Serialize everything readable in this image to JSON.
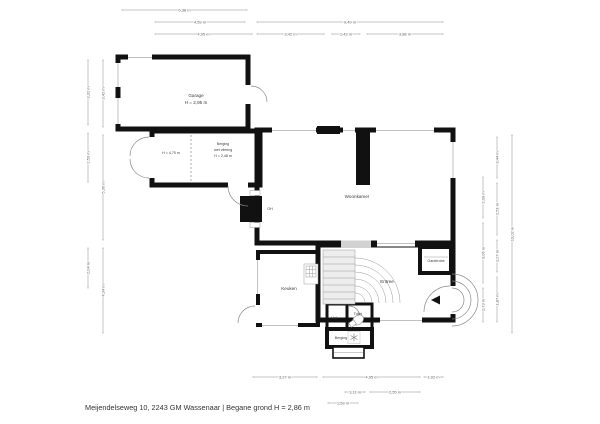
{
  "footer": {
    "text": "Meijendelseweg 10, 2243 GM Wassenaar | Begane grond H = 2,86 m"
  },
  "colors": {
    "wall": "#111111",
    "room_gray": "#d2d2d2",
    "room_pink": "#e8d0cb",
    "room_blue": "#aecbdf",
    "stair_fill": "#ededed"
  },
  "rooms": {
    "garage": {
      "label": "Garage",
      "height": "H = 2,95 m"
    },
    "berging": {
      "label": "Berging",
      "label2": "met vliering",
      "height": "H = 2,48 m"
    },
    "berging_links": {
      "height": "H = 4,70 m"
    },
    "woonkamer": {
      "label": "Woonkamer"
    },
    "open_haard": {
      "label": "OH"
    },
    "keuken": {
      "label": "Keuken"
    },
    "entree": {
      "label": "Entree"
    },
    "garderobe": {
      "label": "Garderobe"
    },
    "hal": {
      "label": "Hal"
    },
    "toilet": {
      "label": "Toilet"
    },
    "berging_klein": {
      "label": "Berging"
    }
  },
  "dims": {
    "top": [
      {
        "label": "6,38 m"
      },
      {
        "label": "4,59 m"
      },
      {
        "label": "9,49 m"
      },
      {
        "label": "4,95 m"
      },
      {
        "label": "3,42 m"
      },
      {
        "label": "1,43 m"
      },
      {
        "label": "3,88 m"
      }
    ],
    "left": [
      {
        "label": "3,32 m"
      },
      {
        "label": "2,50 m"
      },
      {
        "label": "2,04 m"
      },
      {
        "label": "3,42 m"
      },
      {
        "label": "5,36 m"
      },
      {
        "label": "4,34 m"
      }
    ],
    "right": [
      {
        "label": "2,09 m"
      },
      {
        "label": "3,06 m"
      },
      {
        "label": "1,73 m"
      },
      {
        "label": "3,44 m"
      },
      {
        "label": "2,51 m"
      },
      {
        "label": "1,27 m"
      },
      {
        "label": "1,87 m"
      },
      {
        "label": "10,02 m"
      }
    ],
    "bottom": [
      {
        "label": "3,27 m"
      },
      {
        "label": "4,95 m"
      },
      {
        "label": "1,02 m"
      },
      {
        "label": "1,11 m"
      },
      {
        "label": "2,55 m"
      },
      {
        "label": "1,53 m"
      }
    ]
  }
}
